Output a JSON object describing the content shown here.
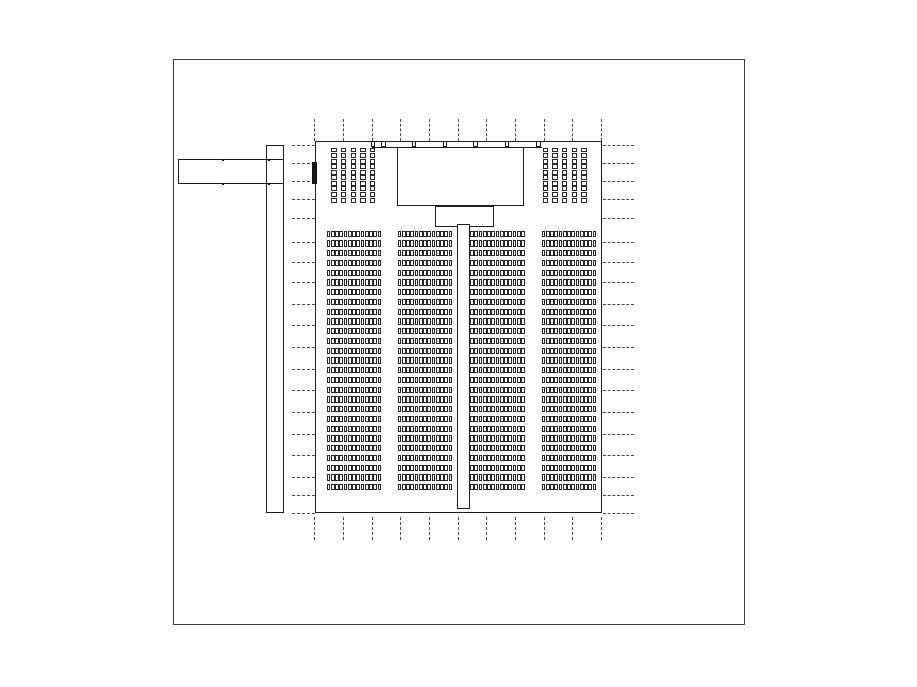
{
  "drawing": {
    "description": "auditorium-floor-plan",
    "canvas": {
      "width": 917,
      "height": 687,
      "background": "#ffffff"
    },
    "colors": {
      "line": "#1f1f1f",
      "frame": "#3c3c3c",
      "grid_dash": "#4a4a4a",
      "seat_border": "#282828",
      "door_fill": "#161616"
    },
    "rects": [
      {
        "name": "outer-frame",
        "cls": "frame",
        "x": 173,
        "y": 59,
        "w": 572,
        "h": 566
      },
      {
        "name": "entrance-corridor",
        "cls": "rect",
        "x": 177.5,
        "y": 159,
        "w": 106,
        "h": 24.5
      },
      {
        "name": "side-corridor-vertical",
        "cls": "rect",
        "x": 266,
        "y": 145,
        "w": 17.5,
        "h": 368
      },
      {
        "name": "hall-outline",
        "cls": "rect",
        "x": 315,
        "y": 141,
        "w": 286.5,
        "h": 372
      },
      {
        "name": "stage",
        "cls": "rect-fill",
        "x": 397,
        "y": 147,
        "w": 126.5,
        "h": 58.5
      },
      {
        "name": "stage-apron",
        "cls": "rect-fill",
        "x": 435,
        "y": 205.5,
        "w": 58.5,
        "h": 21.5
      },
      {
        "name": "center-aisle",
        "cls": "rect-fill",
        "x": 456.5,
        "y": 224,
        "w": 13,
        "h": 285
      },
      {
        "name": "door-marker",
        "cls": "solid-fill",
        "x": 311.5,
        "y": 161.5,
        "w": 5.5,
        "h": 22.5
      }
    ],
    "window_rail": {
      "y": 146.5,
      "x1": 372,
      "x2": 541.5,
      "post_y": 141,
      "post_w": 4.5,
      "post_h": 6,
      "posts_x": [
        370.5,
        381,
        411.5,
        442.5,
        473,
        504.5,
        536
      ]
    },
    "grid": {
      "vertical": {
        "xs": [
          314.3,
          343,
          371.7,
          400.3,
          429,
          457.7,
          486.3,
          515,
          543.7,
          572.3,
          601
        ],
        "top_segment": {
          "y1": 118.5,
          "y2": 140.5
        },
        "bottom_segment": {
          "y1": 517,
          "y2": 539.5
        }
      },
      "horizontal": {
        "ys": [
          144.5,
          162.5,
          181,
          199,
          217.5,
          242,
          262,
          282,
          303.5,
          325,
          346.5,
          368.5,
          390,
          411.5,
          433.5,
          455,
          476.5,
          495,
          512.5
        ],
        "left_segment": {
          "x1": 291.5,
          "x2": 314.5
        },
        "right_segment": {
          "x1": 602.5,
          "x2": 634
        }
      }
    },
    "seating": {
      "main_blocks": {
        "rows": 27,
        "seats_per_row": 13,
        "row_pitch": 9.75,
        "row_height": 6.4,
        "y_start": 230.5,
        "block_width": 55,
        "block_x": [
          326.5,
          397.5,
          470,
          541.5
        ]
      },
      "side_groups": {
        "columns_per_group": 5,
        "seats_per_column": 10,
        "column_pitch": 9.7,
        "column_width": 5.4,
        "y_start": 147.5,
        "column_height": 55,
        "groups_x": [
          331.3,
          542.5
        ]
      }
    },
    "corridor_ticks": {
      "size": 2,
      "points": [
        {
          "x": 222,
          "y": 158.5
        },
        {
          "x": 268,
          "y": 158.5
        },
        {
          "x": 222,
          "y": 182.5
        },
        {
          "x": 268,
          "y": 182.5
        }
      ]
    }
  }
}
